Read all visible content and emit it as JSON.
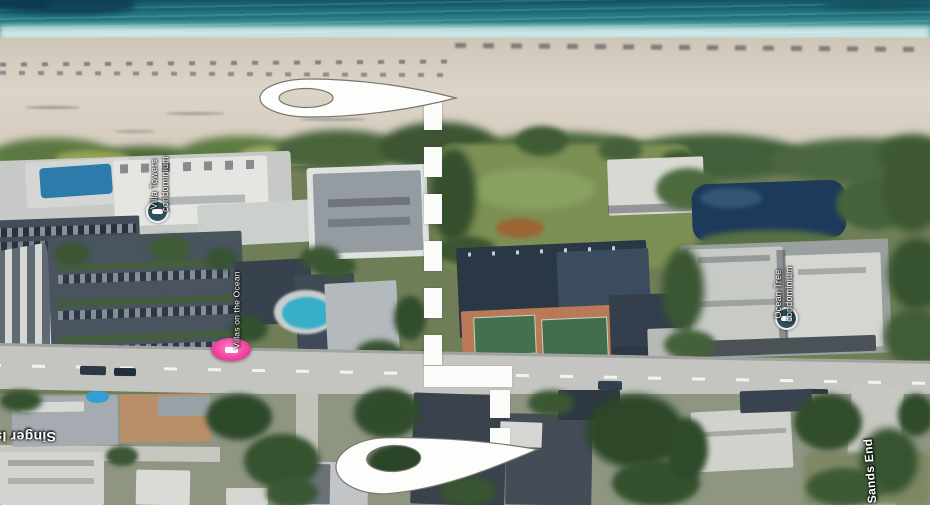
{
  "map": {
    "view": "satellite-aerial",
    "labels": {
      "villa_towers": {
        "line1": "Villa Towers",
        "line2": "condominium"
      },
      "villas_on_the_ocean": {
        "line1": "Villas on the Ocean"
      },
      "ocean_tree": {
        "line1": "Ocean Tree",
        "line2": "condominium"
      },
      "singer_island": {
        "line1": "Singer Island"
      },
      "sands_end": {
        "line1": "Sands End"
      }
    },
    "markers": {
      "origin_pin": "map-pin-white-beach",
      "destination_pin": "map-pin-white-street",
      "villa_towers_poi": "lodging-circle-icon",
      "ocean_tree_poi": "lodging-circle-icon",
      "villas_lodging_marker": "pink-hotel-marker"
    },
    "route": {
      "style": "dashed",
      "color": "#ffffff"
    },
    "colors": {
      "ocean": "#2c8a92",
      "sand": "#d8d0c2",
      "vegetation": "#4c6a3b",
      "road": "#c4c5c0",
      "poi_circle": "#2f4f5c",
      "lodging_pink": "#f0429f",
      "route_white": "#ffffff"
    }
  }
}
